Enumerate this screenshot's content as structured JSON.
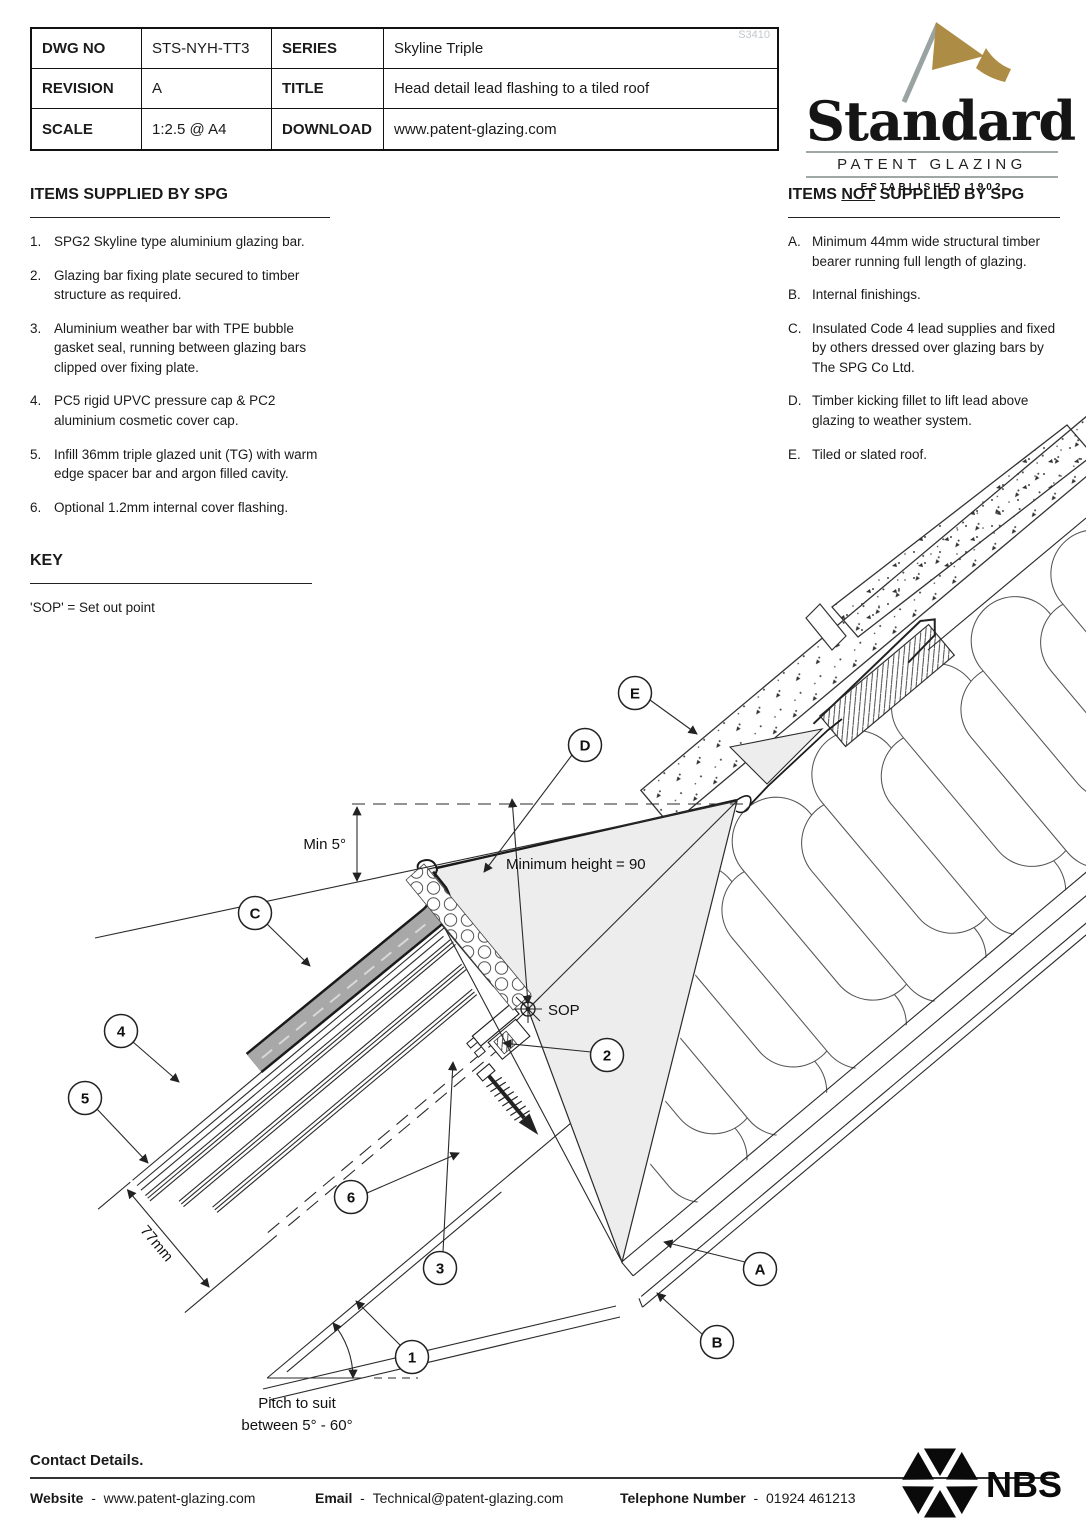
{
  "title_block": {
    "cells": [
      {
        "label": "DWG NO",
        "value": "STS-NYH-TT3"
      },
      {
        "label": "SERIES",
        "value": "Skyline Triple"
      },
      {
        "label": "REVISION",
        "value": "A"
      },
      {
        "label": "TITLE",
        "value": "Head detail lead flashing to a tiled roof"
      },
      {
        "label": "SCALE",
        "value": "1:2.5 @ A4"
      },
      {
        "label": "DOWNLOAD",
        "value": "www.patent-glazing.com"
      }
    ],
    "watermark": "S3410"
  },
  "logo": {
    "name": "Standard",
    "subtitle": "PATENT GLAZING",
    "established": "ESTABLISHED 1902",
    "flag_color": "#ad8d45",
    "pole_color": "#98a3a2"
  },
  "supplied": {
    "heading": "ITEMS SUPPLIED BY SPG",
    "items": [
      {
        "num": "1.",
        "text": "SPG2 Skyline type aluminium glazing bar."
      },
      {
        "num": "2.",
        "text": "Glazing bar fixing plate secured to timber structure as required."
      },
      {
        "num": "3.",
        "text": "Aluminium weather bar with TPE bubble gasket seal, running between glazing bars clipped over fixing plate."
      },
      {
        "num": "4.",
        "text": "PC5 rigid UPVC pressure cap & PC2 aluminium cosmetic cover cap."
      },
      {
        "num": "5.",
        "text": "Infill 36mm triple glazed unit (TG) with warm edge spacer bar and argon filled cavity."
      },
      {
        "num": "6.",
        "text": "Optional 1.2mm internal cover flashing."
      }
    ]
  },
  "not_supplied": {
    "heading_pre": "ITEMS ",
    "heading_not": "NOT",
    "heading_post": " SUPPLIED BY SPG",
    "items": [
      {
        "num": "A.",
        "text": "Minimum 44mm wide structural timber bearer running full length of glazing."
      },
      {
        "num": "B.",
        "text": "Internal finishings."
      },
      {
        "num": "C.",
        "text": "Insulated Code 4 lead supplies and fixed by others dressed over glazing bars by The SPG Co Ltd."
      },
      {
        "num": "D.",
        "text": "Timber kicking fillet to lift lead above glazing to weather system."
      },
      {
        "num": "E.",
        "text": "Tiled or slated roof."
      }
    ]
  },
  "key": {
    "heading": "KEY",
    "text": "'SOP' = Set out point"
  },
  "drawing": {
    "callouts": [
      {
        "label": "1"
      },
      {
        "label": "2"
      },
      {
        "label": "3"
      },
      {
        "label": "4"
      },
      {
        "label": "5"
      },
      {
        "label": "6"
      },
      {
        "label": "A"
      },
      {
        "label": "B"
      },
      {
        "label": "C"
      },
      {
        "label": "D"
      },
      {
        "label": "E"
      }
    ],
    "annotations": {
      "min5": "Min 5°",
      "min_height": "Minimum height = 90",
      "sop": "SOP",
      "dim77": "77mm",
      "pitch_line1": "Pitch to suit",
      "pitch_line2": "between 5° - 60°"
    }
  },
  "footer": {
    "contact": "Contact Details.",
    "website_label": "Website",
    "website_value": "www.patent-glazing.com",
    "email_label": "Email",
    "email_value": "Technical@patent-glazing.com",
    "phone_label": "Telephone Number",
    "phone_value": "01924 461213",
    "separator": "-",
    "nbs": "NBS"
  }
}
